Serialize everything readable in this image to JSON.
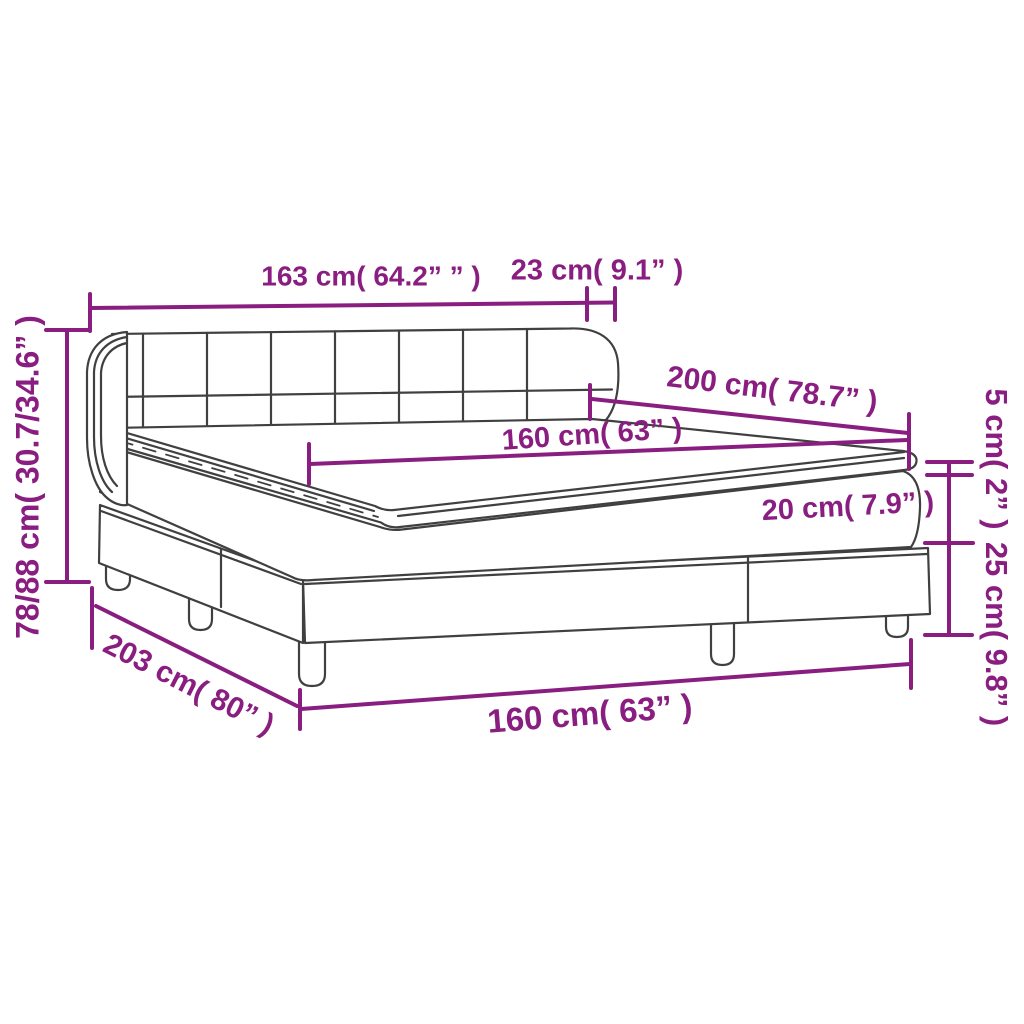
{
  "diagram": {
    "type": "product-dimension-diagram",
    "product": "box-spring-bed-with-headboard-and-topper",
    "colors": {
      "dimension": "#8A1E80",
      "drawing": "#404040",
      "background": "#FFFFFF"
    },
    "labels": {
      "headboard_width": "163 cm( 64.2” ” )",
      "headboard_depth": "23 cm( 9.1” )",
      "total_height": "78/88 cm( 30.7/34.6” )",
      "bed_length": "200 cm( 78.7” )",
      "mattress_width": "160 cm( 63” )",
      "mattress_height": "20 cm( 7.9” )",
      "topper_height": "5 cm( 2” )",
      "base_height": "25 cm( 9.8” )",
      "frame_length": "203 cm( 80” )",
      "frame_width": "160 cm( 63” )"
    }
  }
}
